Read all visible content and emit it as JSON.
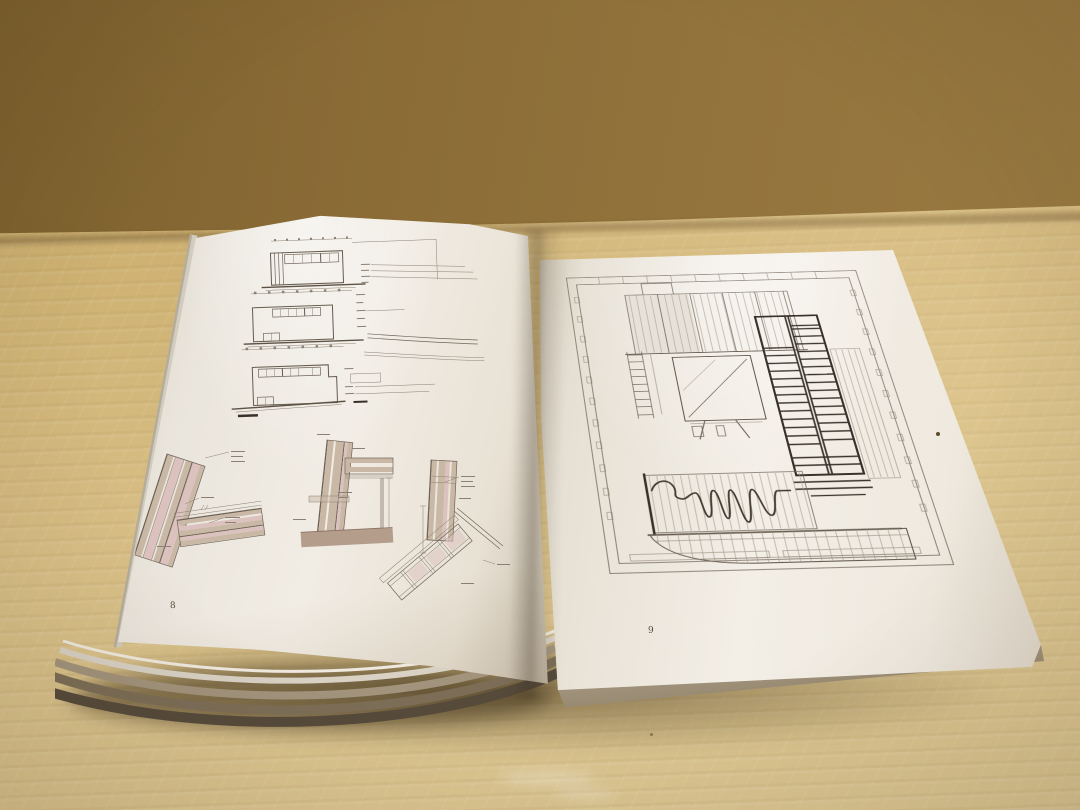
{
  "scene": {
    "colors": {
      "wall": "#8f7140",
      "table": "#d3b97f",
      "paper": "#efeae2",
      "drawing_line": "#655b4e",
      "heavy_line": "#38302a",
      "hatch_pink": "#dcc2bf",
      "hatch_tan": "#c9b8a5",
      "ground_brown": "#b49d8b",
      "page_edge_dark": "#564a3b"
    }
  },
  "book": {
    "left_page": {
      "page_number": "8"
    },
    "right_page": {
      "page_number": "9"
    }
  }
}
